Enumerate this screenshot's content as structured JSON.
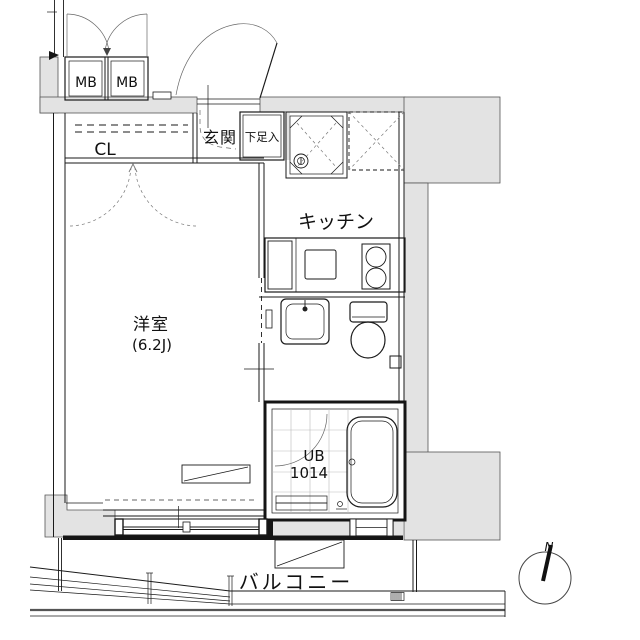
{
  "floor_plan": {
    "labels": {
      "meter_box_1": "MB",
      "meter_box_2": "MB",
      "closet": "CL",
      "entrance": "玄関",
      "shoe_storage": "下足入",
      "kitchen": "キッチン",
      "room_name": "洋室",
      "room_size": "(6.2J)",
      "bath_type": "UB",
      "bath_size": "1014",
      "balcony": "バルコニー",
      "north": "N"
    },
    "colors": {
      "wall_fill": "#e3e3e3",
      "line": "#1a1a1a",
      "background": "#ffffff"
    }
  }
}
